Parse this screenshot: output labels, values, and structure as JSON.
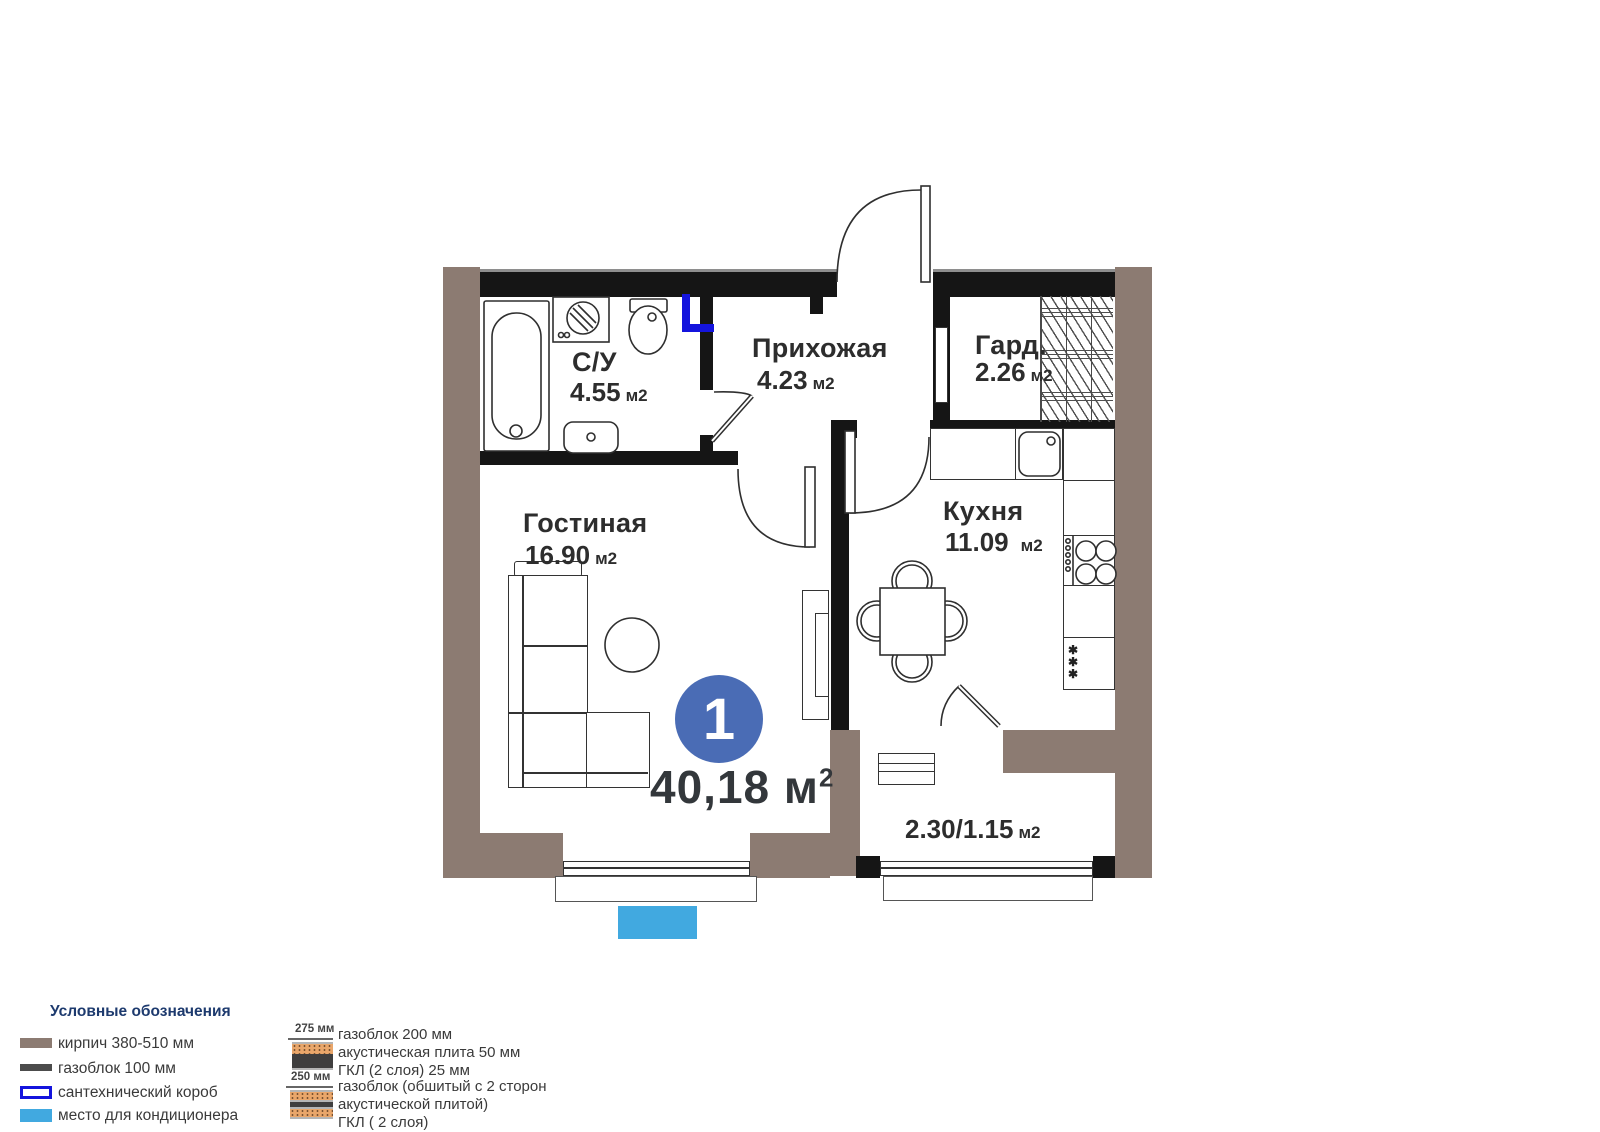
{
  "plan": {
    "badge": "1",
    "total": {
      "value": "40,18",
      "unit": "м",
      "sup": "2"
    },
    "rooms": {
      "bathroom": {
        "name": "С/У",
        "area": "4.55",
        "unit": "м2"
      },
      "hallway": {
        "name": "Прихожая",
        "area": "4.23",
        "unit": "м2"
      },
      "wardrobe": {
        "name": "Гард.",
        "area": "2.26",
        "unit": "м2"
      },
      "living": {
        "name": "Гостиная",
        "area": "16.90",
        "unit": "м2"
      },
      "kitchen": {
        "name": "Кухня",
        "area": "11.09",
        "unit": "м2"
      },
      "balcony": {
        "area": "2.30/1.15",
        "unit": "м2"
      }
    },
    "fixtures": {
      "fridge_mark": "✱"
    }
  },
  "legend": {
    "title": "Условные обозначения",
    "items": [
      {
        "label": "кирпич 380-510 мм"
      },
      {
        "label": "газоблок 100 мм"
      },
      {
        "label": "сантехнический короб"
      },
      {
        "label": "место для кондиционера"
      }
    ]
  },
  "wall_sections": [
    {
      "size": "275 мм",
      "lines": [
        "газоблок 200 мм",
        "акустическая плита 50 мм",
        "ГКЛ (2 слоя) 25 мм"
      ]
    },
    {
      "size": "250 мм",
      "lines": [
        "газоблок (обшитый с 2 сторон",
        "акустической плитой)",
        "ГКЛ ( 2 слоя)"
      ]
    }
  ],
  "colors": {
    "brick": "#8c7b72",
    "gasblock": "#4c4c4c",
    "plumbing_blue": "#1414dd",
    "ac_blue": "#41a9e0",
    "badge_blue": "#4a6cb5"
  }
}
